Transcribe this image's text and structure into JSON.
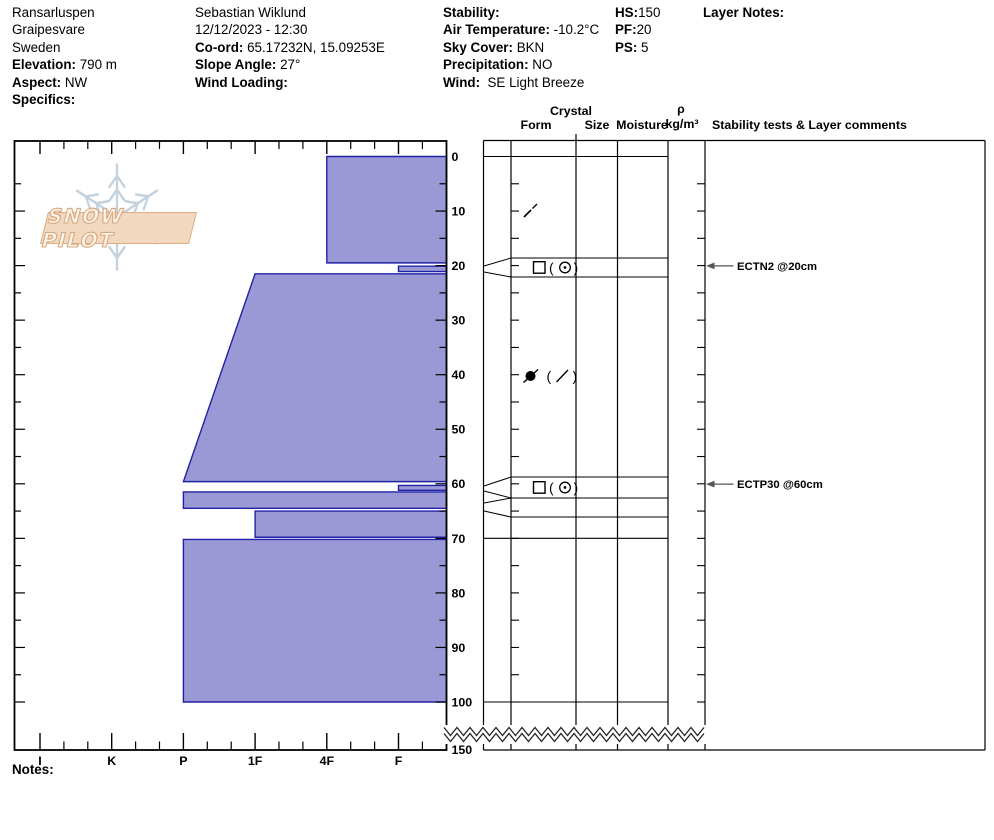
{
  "header": {
    "location": {
      "name": "Ransarluspen",
      "area": "Graipesvare",
      "country": "Sweden",
      "elevation_label": "Elevation:",
      "elevation": " 790 m",
      "aspect_label": "Aspect:",
      "aspect": " NW",
      "specifics_label": "Specifics:",
      "specifics": ""
    },
    "observer": {
      "name": "Sebastian Wiklund",
      "datetime": "12/12/2023 - 12:30",
      "coord_label": "Co-ord:",
      "coord": " 65.17232N, 15.09253E",
      "slope_label": "Slope Angle:",
      "slope": " 27°",
      "wind_loading_label": "Wind Loading:",
      "wind_loading": ""
    },
    "conditions": {
      "stability_label": "Stability:",
      "stability": "",
      "air_temp_label": "Air Temperature:",
      "air_temp": " -10.2°C",
      "sky_label": "Sky Cover:",
      "sky": " BKN",
      "precip_label": "Precipitation:",
      "precip": " NO",
      "wind_label": "Wind:",
      "wind": "  SE Light Breeze"
    },
    "snowpack": {
      "hs_label": "HS:",
      "hs": "150",
      "pf_label": "PF:",
      "pf": "20",
      "ps_label": "PS:",
      "ps": " 5"
    },
    "layer_notes_label": "Layer Notes:"
  },
  "logo": {
    "text": "SNOW PILOT"
  },
  "table_headers": {
    "crystal": "Crystal",
    "form": "Form",
    "size": "Size",
    "moisture": "Moisture",
    "rho": "ρ",
    "rho_units": "kg/m³",
    "comments": "Stability tests & Layer comments"
  },
  "notes_label": "Notes:",
  "chart_data": {
    "type": "bar",
    "title": "Snow pit hardness profile",
    "depth_axis": {
      "unit": "cm",
      "ticks": [
        0,
        10,
        20,
        30,
        40,
        50,
        60,
        70,
        80,
        90,
        100,
        150
      ],
      "break_between": [
        100,
        150
      ],
      "total_depth": 150
    },
    "hardness_axis": {
      "categories": [
        "I",
        "K",
        "P",
        "1F",
        "4F",
        "F"
      ]
    },
    "layers": [
      {
        "top": 0,
        "bottom": 19.5,
        "hardness": "4F"
      },
      {
        "top": 20.1,
        "bottom": 21.1,
        "hardness": "F"
      },
      {
        "top": 21.5,
        "bottom": 59.6,
        "hardness_top": "1F",
        "hardness_bottom": "P"
      },
      {
        "top": 60.3,
        "bottom": 61.2,
        "hardness": "F"
      },
      {
        "top": 61.5,
        "bottom": 64.5,
        "hardness": "P"
      },
      {
        "top": 65.0,
        "bottom": 69.8,
        "hardness": "1F"
      },
      {
        "top": 70.2,
        "bottom": 100,
        "hardness": "P"
      }
    ],
    "grain_forms": [
      {
        "depth": 10,
        "symbol": "df-slash",
        "display": "⁄"
      },
      {
        "depth": 20.5,
        "symbol": "fc-paren-mm",
        "display": "□ (⊙)"
      },
      {
        "depth": 40.2,
        "symbol": "rg-paren-df",
        "display": "●̸ ( ⁄ )"
      },
      {
        "depth": 60.7,
        "symbol": "fc-paren-mm",
        "display": "□ (⊙)"
      }
    ],
    "tests": [
      {
        "text": "ECTN2 @20cm",
        "depth": 20
      },
      {
        "text": "ECTP30 @60cm",
        "depth": 60
      }
    ],
    "colors": {
      "layer_fill": "#9a99d6",
      "layer_border": "#2121a8"
    }
  }
}
